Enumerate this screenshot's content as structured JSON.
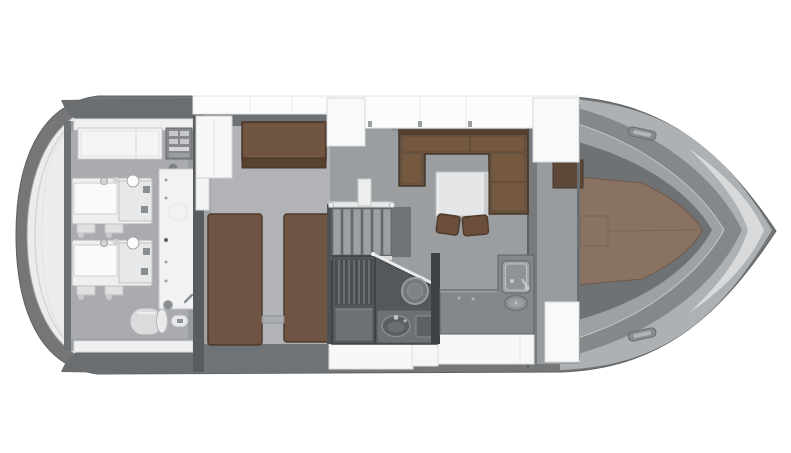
{
  "title": "Motor yacht lower-deck floor plan (3D top-down render)",
  "background": "#ffffff",
  "palette": {
    "hull_band": "#747678",
    "swim_platform": "#ebeced",
    "hardtop_dark": "#6b6e71",
    "deck_white": "#fbfcfc",
    "floor_gray": "#9b9ea1",
    "aft_cabin_floor": "#b1b3b6",
    "wood_beds": "#6f5444",
    "wood_sofa": "#66503e",
    "wood_vberth": "#8a7263",
    "head_floor": "#54575b",
    "galley_counter": "#85888b",
    "steel_sink": "#a3a6a9",
    "machinery_white": "#eef0f0"
  },
  "rooms": [
    {
      "id": "swim-platform"
    },
    {
      "id": "engine-room",
      "equipment": [
        "port-engine",
        "starboard-engine",
        "generator-cabinet",
        "electrical-panel",
        "water-heater",
        "storage-bench"
      ]
    },
    {
      "id": "aft-cabin",
      "furniture": [
        "twin-bed-port",
        "twin-bed-starboard",
        "sofa-seat",
        "wardrobe"
      ]
    },
    {
      "id": "companionway-stairs"
    },
    {
      "id": "head-compartment",
      "fixtures": [
        "shower",
        "toilet",
        "washbasin-vanity"
      ]
    },
    {
      "id": "salon",
      "furniture": [
        "u-shaped-sofa",
        "coffee-table",
        "stool",
        "stool"
      ]
    },
    {
      "id": "galley",
      "fixtures": [
        "counter",
        "sink",
        "cooktop"
      ]
    },
    {
      "id": "bow-cabin",
      "furniture": [
        "v-berth"
      ],
      "deck_hatches": [
        "forward-top-hatch",
        "forward-bottom-hatch"
      ]
    }
  ]
}
